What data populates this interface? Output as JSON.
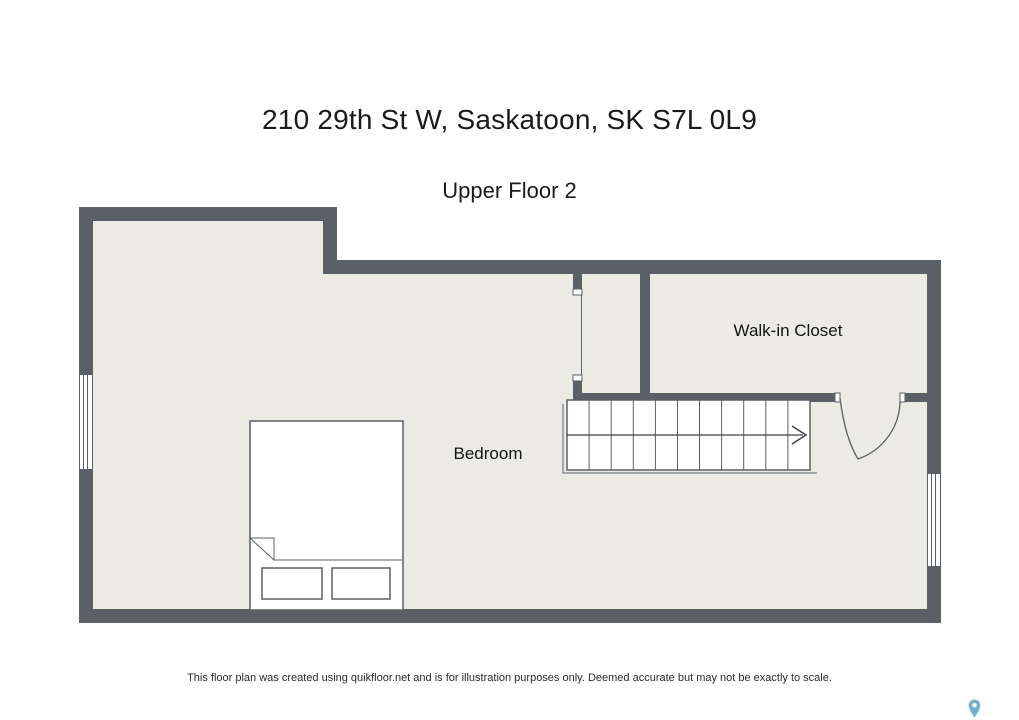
{
  "header": {
    "title": "210 29th St W, Saskatoon, SK S7L 0L9",
    "subtitle": "Upper Floor 2"
  },
  "floor_plan": {
    "rooms": [
      {
        "label": "Bedroom"
      },
      {
        "label": "Walk-in Closet"
      }
    ],
    "features": {
      "stairs": {
        "treads": 11,
        "direction_arrow": "right"
      },
      "door": {
        "location": "between stairwell hall and walk-in closet wall",
        "swing": "into bedroom"
      },
      "bed": {
        "pillows": 2,
        "folded_corner": true
      },
      "windows": [
        {
          "wall": "left"
        },
        {
          "wall": "right"
        }
      ],
      "stairwell_opening": true
    },
    "colors": {
      "wall": "#5a6065",
      "floor": "#ebebe3",
      "outline": "#5a6065",
      "symbol_fill": "#ffffff"
    }
  },
  "footer": {
    "disclaimer": "This floor plan was created using quikfloor.net and is for illustration purposes only. Deemed accurate but may not be exactly to scale."
  },
  "icons": {
    "map_pin": {
      "name": "map-pin-icon",
      "color": "#72b0d2"
    }
  }
}
